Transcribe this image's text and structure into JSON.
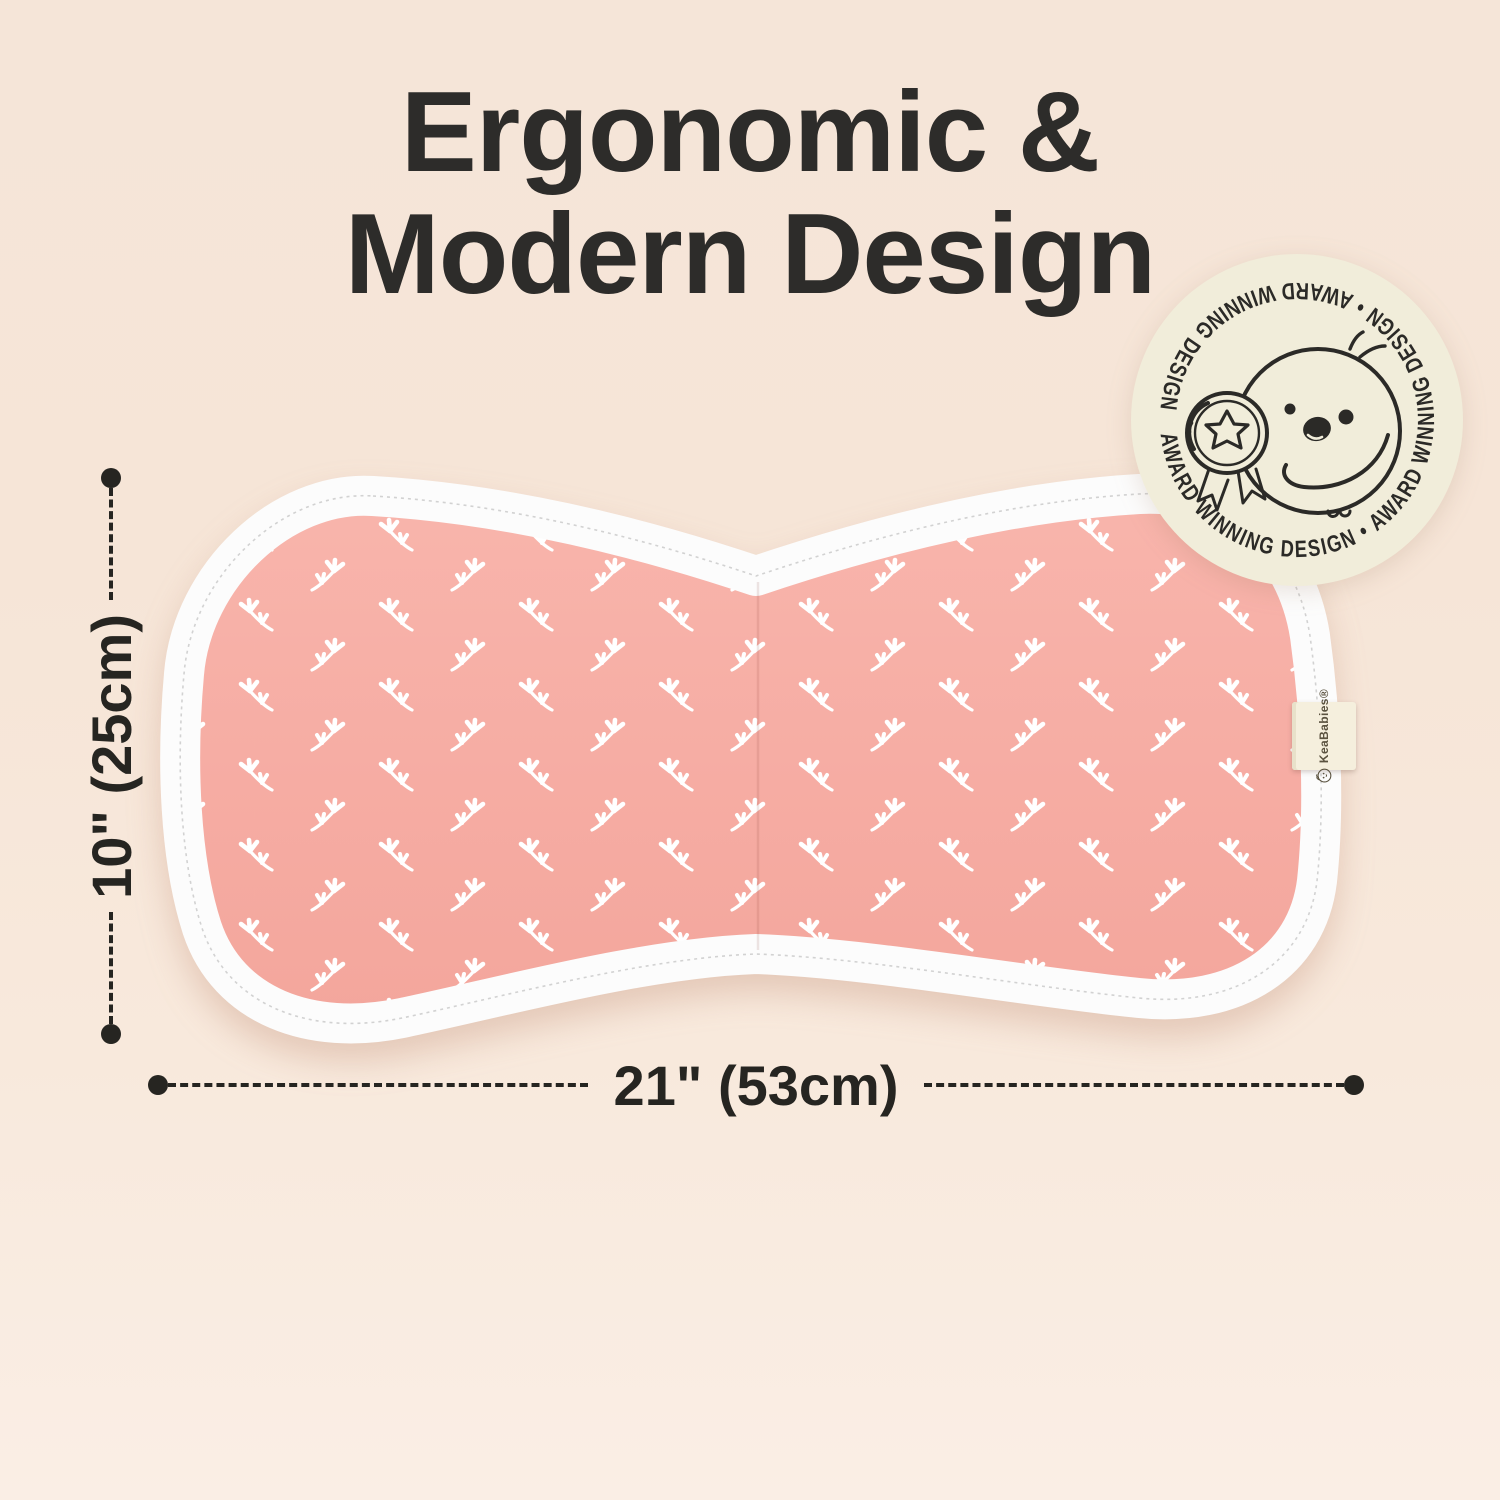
{
  "title": {
    "line1": "Ergonomic &",
    "line2": "Modern Design"
  },
  "award_badge": {
    "ring_text": "AWARD WINNING DESIGN • AWARD WINNING DESIGN • AWARD WINNING DESIGN •",
    "mascot": "chick-holding-star-medal",
    "bg_color": "#f1edda"
  },
  "product": {
    "type": "contoured burp cloth",
    "brand_tag": "KeaBabies®",
    "fabric_color": "#f6aca3",
    "binding_color": "#fcfcfc",
    "pattern": "white flower sprigs"
  },
  "dimensions": {
    "height_label": "10\" (25cm)",
    "width_label": "21\" (53cm)",
    "line_color": "#262521"
  },
  "colors": {
    "background_top": "#f5e5d8",
    "background_bottom": "#faeee5",
    "text": "#2d2c2a"
  }
}
